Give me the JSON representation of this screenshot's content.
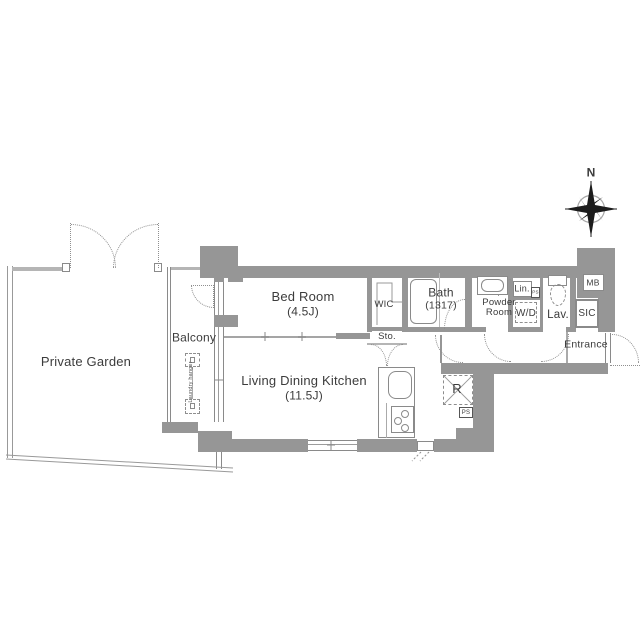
{
  "title": "apartment-floor-plan",
  "colors": {
    "wall": "#969696",
    "thin_line": "#8a8a8a",
    "fence": "#b5b5b5",
    "dotted": "#8f8f8f",
    "text": "#3c3c3c"
  },
  "compass": {
    "label": "N"
  },
  "rooms": {
    "private_garden": {
      "label": "Private Garden"
    },
    "balcony": {
      "label": "Balcony"
    },
    "bed_room": {
      "label": "Bed Room",
      "size": "(4.5J)"
    },
    "ldk": {
      "label": "Living Dining Kitchen",
      "size": "(11.5J)"
    },
    "wic": {
      "label": "WIC"
    },
    "sto": {
      "label": "Sto."
    },
    "bath": {
      "label": "Bath",
      "size": "(1317)"
    },
    "powder_room": {
      "label_line1": "Powder",
      "label_line2": "Room"
    },
    "lin": {
      "label": "Lin."
    },
    "wd": {
      "label": "W/D"
    },
    "lav": {
      "label": "Lav."
    },
    "mb": {
      "label": "MB"
    },
    "sic": {
      "label": "SIC"
    },
    "entrance": {
      "label": "Entrance"
    }
  },
  "fixtures": {
    "refrigerator": {
      "label": "R"
    },
    "pipe_shaft_upper": {
      "label": "PS"
    },
    "pipe_shaft_lower": {
      "label": "PS"
    },
    "laundry_hanger": {
      "label": "Laundry hanger"
    }
  }
}
